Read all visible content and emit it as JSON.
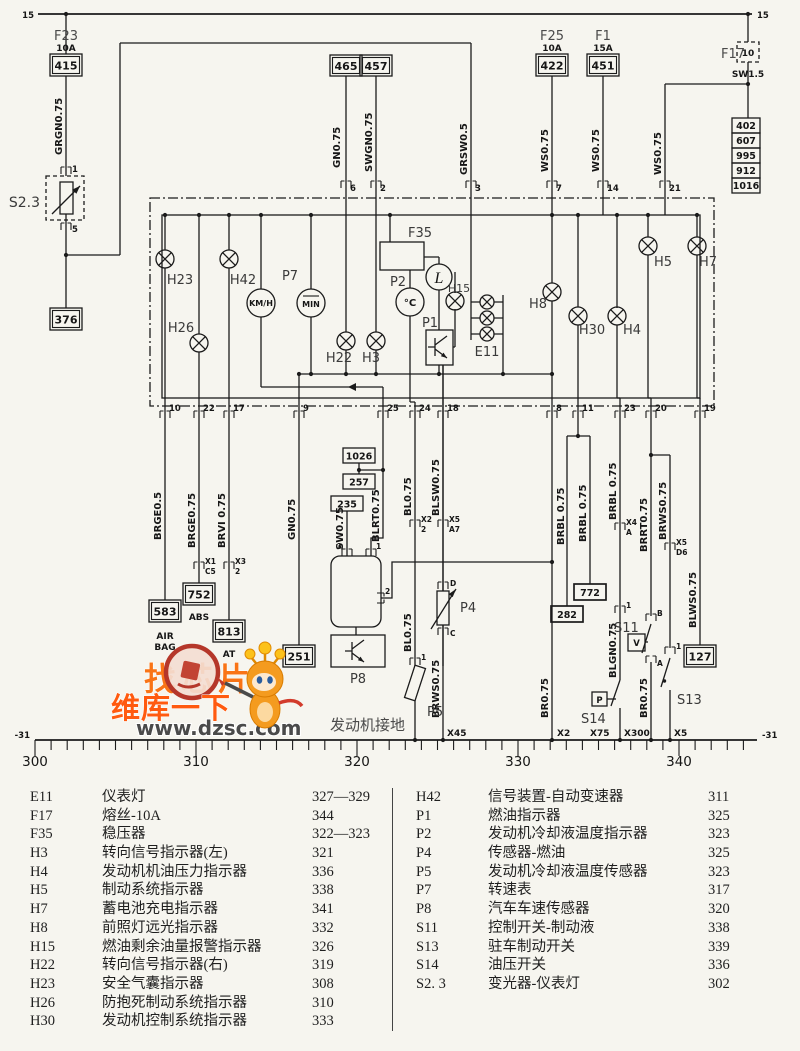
{
  "watermark": {
    "slogan": "找芯片",
    "brand": "维库一下",
    "url": "www.dzsc.com"
  },
  "diagram": {
    "rails": {
      "top_left": "15",
      "top_right": "15",
      "ground_left": "-31",
      "ground_right": "-31",
      "ground_text": "发动机接地"
    },
    "ruler": [
      "300",
      "310",
      "320",
      "330",
      "340"
    ],
    "fuses": {
      "f23": "F23",
      "f23_amp": "10A",
      "f23_box": "415",
      "f25": "F25",
      "f25_amp": "10A",
      "f25_box": "422",
      "f1": "F1",
      "f1_amp": "15A",
      "f1_box": "451",
      "f17": "F17",
      "f17_value": "10",
      "f17_wire": "SW1.5"
    },
    "ref_boxes": {
      "b376": "376",
      "b465": "465",
      "b457": "457",
      "b402": "402",
      "b607": "607",
      "b995": "995",
      "b912": "912",
      "b1016": "1016",
      "b583": "583",
      "b583_sub1": "AIR",
      "b583_sub2": "BAG",
      "b752": "752",
      "b752_sub": "ABS",
      "b813": "813",
      "b813_sub": "AT",
      "b251": "251",
      "b1026": "1026",
      "b257": "257",
      "b235": "235",
      "b772": "772",
      "b282": "282",
      "b127": "127"
    },
    "wires": {
      "grgn": "GRGN0.75",
      "gn_top": "GN0.75",
      "swgn": "SWGN0.75",
      "grsw": "GRSW0.5",
      "ws_7": "WS0.75",
      "ws_14": "WS0.75",
      "ws_21": "WS0.75",
      "brge05": "BRGE0.5",
      "brge075": "BRGE0.75",
      "brvi": "BRVI 0.75",
      "gn_9": "GN0.75",
      "sw075": "SW0.75",
      "blrt": "BLRT0.75",
      "bl_upper": "BL0.75",
      "bl_lower": "BL0.75",
      "blsw": "BLSW0.75",
      "brws_p4": "BRWS0.75",
      "br_x2": "BR0.75",
      "brbl_282": "BRBL 0.75",
      "brbl_772": "BRBL 0.75",
      "brbl_23": "BRBL 0.75",
      "blgn": "BLGN0.75",
      "brrt": "BRRT0.75",
      "brws_s13": "BRWS0.75",
      "br_x300": "BR0.75",
      "blws": "BLWS0.75"
    },
    "components": {
      "s23": "S2.3",
      "s23_pin1": "1",
      "s23_pin5": "5",
      "h23": "H23",
      "h26": "H26",
      "h42": "H42",
      "p7": "P7",
      "kmh": "KM/H",
      "min": "MIN",
      "h22": "H22",
      "h3": "H3",
      "f35": "F35",
      "p2": "P2",
      "p2_unit": "°C",
      "l_gauge": "L",
      "p1": "P1",
      "h15": "H15",
      "e11": "E11",
      "h8": "H8",
      "h30": "H30",
      "h4": "H4",
      "h5": "H5",
      "h7": "H7",
      "p8": "P8",
      "p8_pin3": "3",
      "p8_pin1": "1",
      "p8_pin2": "2",
      "p5": "P5",
      "p5_pin1": "1",
      "p4": "P4",
      "p4_pind": "D",
      "p4_pinc": "C",
      "s11": "S11",
      "s11_sym": "V",
      "s11_pinb": "B",
      "s11_pina": "A",
      "s13": "S13",
      "s13_pin1": "1",
      "s14": "S14",
      "s14_sym": "P"
    },
    "pins_top": [
      "6",
      "2",
      "3",
      "7",
      "14",
      "21"
    ],
    "pins_bottom": [
      "10",
      "22",
      "17",
      "9",
      "25",
      "24",
      "18",
      "8",
      "11",
      "23",
      "20",
      "19"
    ],
    "connectors": {
      "x1": "X1",
      "x1_pin": "C5",
      "x3": "X3",
      "x3_pin": "2",
      "x2": "X2",
      "x2_pin": "2",
      "x5": "X5",
      "x5_pin": "A7",
      "x4": "X4",
      "x4_pin": "A",
      "x5d": "X5",
      "x5d_pin": "D6"
    },
    "grounds": {
      "x45": "X45",
      "x2": "X2",
      "x75": "X75",
      "x300": "X300",
      "x5": "X5"
    }
  },
  "legend": {
    "left": [
      {
        "code": "E11",
        "name": "仪表灯",
        "page": "327—329"
      },
      {
        "code": "F17",
        "name": "熔丝-10A",
        "page": "344"
      },
      {
        "code": "F35",
        "name": "稳压器",
        "page": "322—323"
      },
      {
        "code": "H3",
        "name": "转向信号指示器(左)",
        "page": "321"
      },
      {
        "code": "H4",
        "name": "发动机机油压力指示器",
        "page": "336"
      },
      {
        "code": "H5",
        "name": "制动系统指示器",
        "page": "338"
      },
      {
        "code": "H7",
        "name": "蓄电池充电指示器",
        "page": "341"
      },
      {
        "code": "H8",
        "name": "前照灯远光指示器",
        "page": "332"
      },
      {
        "code": "H15",
        "name": "燃油剩余油量报警指示器",
        "page": "326"
      },
      {
        "code": "H22",
        "name": "转向信号指示器(右)",
        "page": "319"
      },
      {
        "code": "H23",
        "name": "安全气囊指示器",
        "page": "308"
      },
      {
        "code": "H26",
        "name": "防抱死制动系统指示器",
        "page": "310"
      },
      {
        "code": "H30",
        "name": "发动机控制系统指示器",
        "page": "333"
      }
    ],
    "right": [
      {
        "code": "H42",
        "name": "信号装置-自动变速器",
        "page": "311"
      },
      {
        "code": "P1",
        "name": "燃油指示器",
        "page": "325"
      },
      {
        "code": "P2",
        "name": "发动机冷却液温度指示器",
        "page": "323"
      },
      {
        "code": "P4",
        "name": "传感器-燃油",
        "page": "325"
      },
      {
        "code": "P5",
        "name": "发动机冷却液温度传感器",
        "page": "323"
      },
      {
        "code": "P7",
        "name": "转速表",
        "page": "317"
      },
      {
        "code": "P8",
        "name": "汽车车速传感器",
        "page": "320"
      },
      {
        "code": "S11",
        "name": "控制开关-制动液",
        "page": "338"
      },
      {
        "code": "S13",
        "name": "驻车制动开关",
        "page": "339"
      },
      {
        "code": "S14",
        "name": "油压开关",
        "page": "336"
      },
      {
        "code": "S2. 3",
        "name": "变光器-仪表灯",
        "page": "302"
      }
    ]
  }
}
